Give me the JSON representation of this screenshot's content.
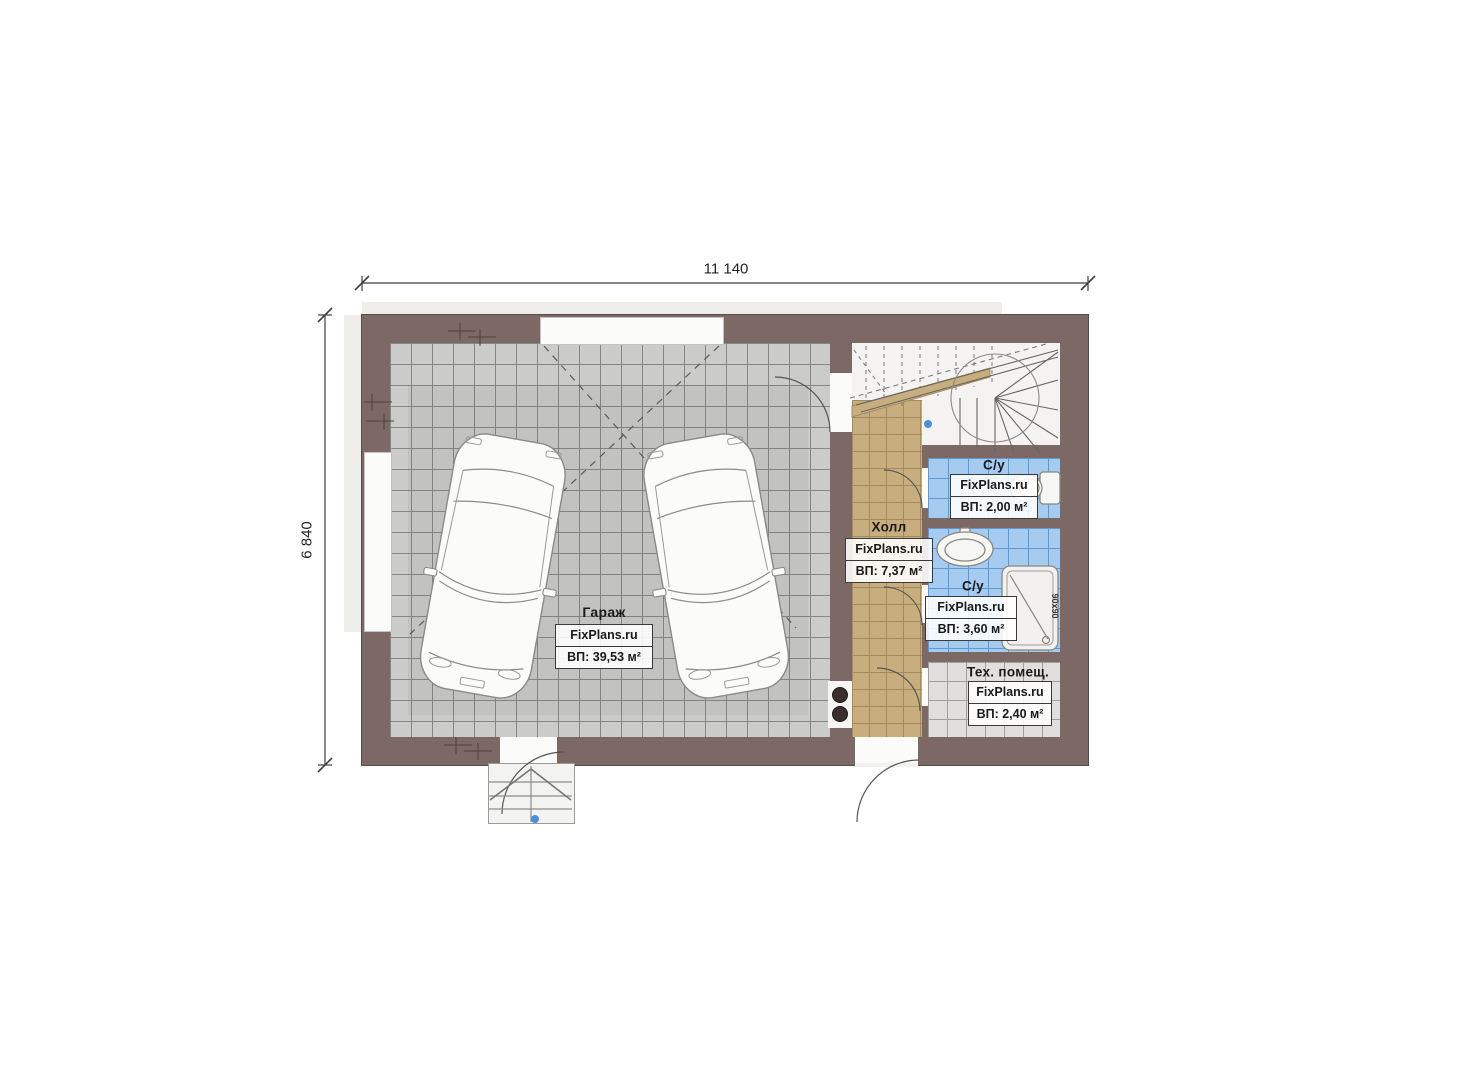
{
  "plan_title": "First floor plan",
  "dimensions": {
    "width_label": "11 140",
    "height_label": "6 840"
  },
  "rooms": {
    "garage": {
      "name": "Гараж",
      "watermark": "FixPlans.ru",
      "area": "ВП: 39,53 м²"
    },
    "hall": {
      "name": "Холл",
      "watermark": "FixPlans.ru",
      "area": "ВП: 7,37 м²"
    },
    "bathroom_small": {
      "name": "С/у",
      "watermark": "FixPlans.ru",
      "area": "ВП: 2,00 м²"
    },
    "bathroom_large": {
      "name": "С/у",
      "watermark": "FixPlans.ru",
      "area": "ВП: 3,60 м²"
    },
    "tech_room": {
      "name": "Тех. помещ.",
      "watermark": "FixPlans.ru",
      "area": "ВП: 2,40 м²"
    }
  },
  "fixtures": {
    "shower_size_label": "90x90"
  },
  "colors": {
    "wall": "#7c6864",
    "garage_tile": "#cbcbca",
    "hall_tile": "#c8ad7e",
    "bath_tile": "#a6cbf1",
    "tech_tile": "#e0dfdd",
    "marker_blue": "#4a90d9",
    "line": "#555555"
  }
}
